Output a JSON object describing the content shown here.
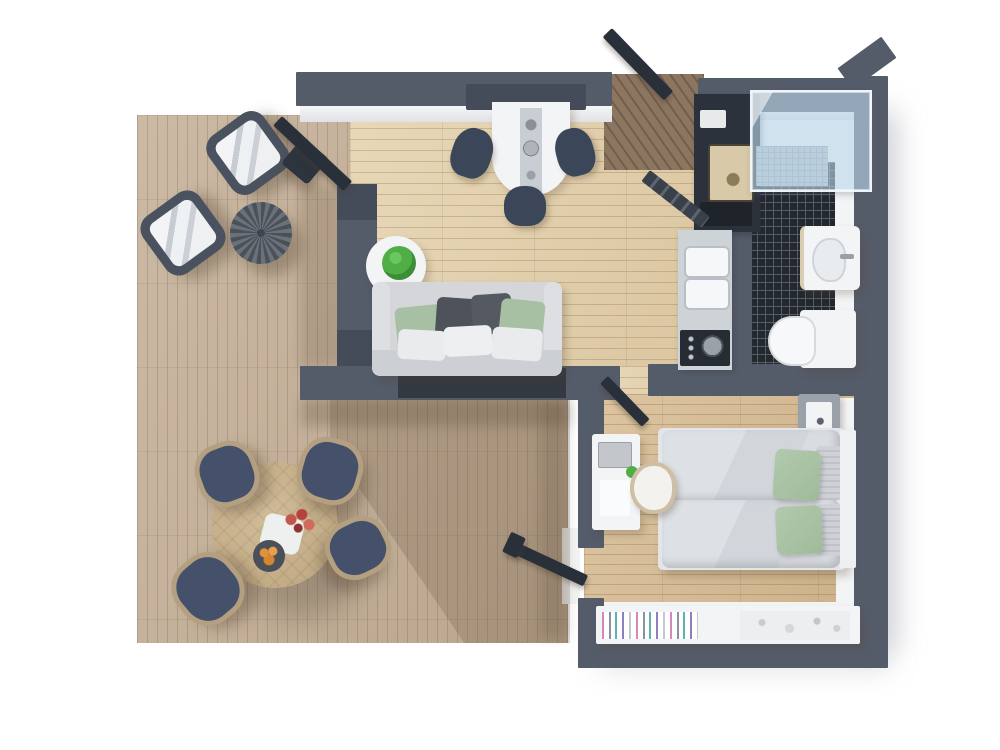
{
  "meta": {
    "title": "3D rendered one-bedroom apartment floor plan, top-down view"
  },
  "palette": {
    "wall": "#545b69",
    "wall_dark": "#2a303a",
    "deck_wood": "#c4ae95",
    "interior_wood": "#e2cda5",
    "bedroom_wood": "#d7bb91",
    "entry_wood": "#8d7660",
    "tile_black": "#23272e",
    "glass_blue": "#bad6ea",
    "sofa_gray": "#d4d6d9",
    "accent_green": "#a9c3a5",
    "chair_navy": "#3c4659",
    "white_furniture": "#f3f4f6"
  },
  "labels": {
    "plan": "Apartment floor plan render",
    "terrace": "Terrace deck",
    "living_room": "Living room",
    "kitchen": "Kitchen",
    "bathroom": "Bathroom",
    "bedroom": "Bedroom",
    "entry": "Entry",
    "lounge_chair": "Lounge chair with cushion",
    "wicker_ottoman": "Round wicker ottoman",
    "side_table": "Side table",
    "outdoor_table": "Round outdoor dining table",
    "outdoor_chair": "Outdoor dining chair",
    "fruit_bowl": "Fruit bowl",
    "flowers": "Flowers",
    "plate": "Plate",
    "dining_table": "Wall-mounted dining table with steel inset",
    "dining_chair": "Dining chair",
    "hood_panel": "Wall panel above table",
    "plant_table": "Side table with potted plant",
    "potted_plant": "Potted plant",
    "sofa": "Sofa with cushions",
    "tall_unit": "Tall kitchen unit with appliances",
    "coffee_machine": "Countertop appliance",
    "oven": "Built-in oven",
    "ladder_rack": "Ladder rack",
    "kitchen_counter": "Kitchen counter",
    "sink": "Kitchen sink basin",
    "cooktop": "Cooktop",
    "shower": "Glass shower enclosure",
    "shower_floor": "Shower floor drain area",
    "bath_sink": "Bathroom washbasin",
    "toilet": "Toilet",
    "nightstand": "Nightstand",
    "bed": "Double bed",
    "duvet": "Duvet",
    "green_pillow": "Green pillow",
    "stripe_pillow": "Striped pillow",
    "headboard": "Headboard",
    "desk": "Desk with monitor",
    "monitor": "Monitor",
    "desk_chair": "Desk chair",
    "desk_plant": "Small plant",
    "shelf": "Low shelf unit",
    "books": "Books",
    "clothes": "Folded clothes",
    "open_door": "Open door",
    "wall": "Wall",
    "floor_shadow": "Cast shadow"
  }
}
